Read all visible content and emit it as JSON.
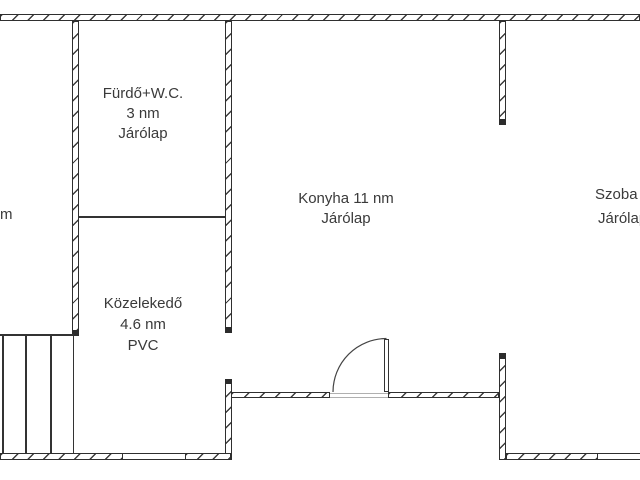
{
  "rooms": {
    "bathroom": {
      "lines": [
        "Fürdő+W.C.",
        "3 nm",
        "Járólap"
      ]
    },
    "kitchen": {
      "lines": [
        "Konyha 11 nm",
        "Járólap"
      ]
    },
    "room": {
      "lines": [
        "Szoba",
        "Járólap"
      ]
    },
    "hallway": {
      "lines": [
        "Közelekedő",
        "4.6 nm",
        "PVC"
      ]
    },
    "left_room_fragment": {
      "lines": [
        "m"
      ]
    }
  },
  "colors": {
    "wall": "#2f2f2f",
    "text": "#3a3a3a",
    "threshold": "#b0b0b0",
    "background": "#ffffff"
  }
}
